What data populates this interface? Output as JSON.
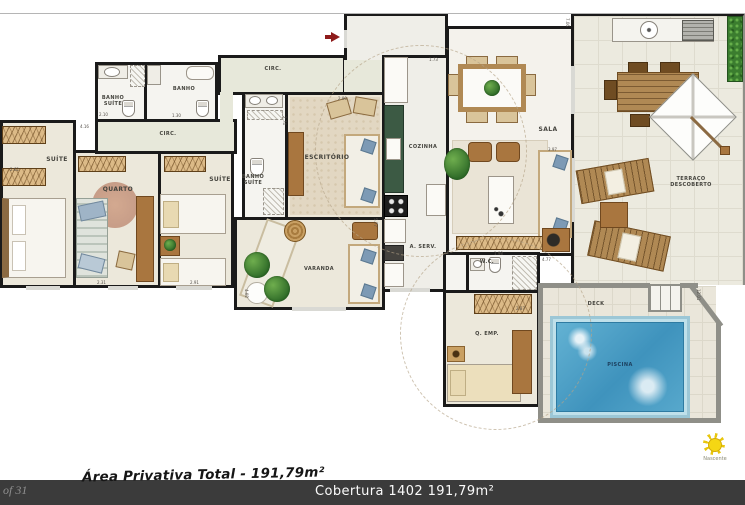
{
  "rooms": {
    "suite1": "SUÍTE",
    "quarto": "QUARTO",
    "suite2": "SUÍTE",
    "banho_suite1": "BANHO SUÍTE",
    "banho": "BANHO",
    "circ1": "CIRC.",
    "circ2": "CIRC.",
    "banho_suite2": "BANHO SUÍTE",
    "escritorio": "ESCRITÓRIO",
    "cozinha": "COZINHA",
    "a_serv": "A. SERV.",
    "sala": "SALA",
    "varanda": "VARANDA",
    "wc": "W.C.",
    "q_emp": "Q. EMP.",
    "terraco": "TERRAÇO DESCOBERTO",
    "deck": "DECK",
    "piscina": "PISCINA"
  },
  "dimensions": [
    {
      "t": "2.10",
      "x": 99,
      "y": 112,
      "r": 0
    },
    {
      "t": "4.16",
      "x": 80,
      "y": 124,
      "r": 0
    },
    {
      "t": "1.30",
      "x": 172,
      "y": 113,
      "r": 0
    },
    {
      "t": "2.62",
      "x": 10,
      "y": 167,
      "r": 0
    },
    {
      "t": "2.31",
      "x": 97,
      "y": 280,
      "r": 0
    },
    {
      "t": "2.91",
      "x": 190,
      "y": 280,
      "r": 0
    },
    {
      "t": "4.02",
      "x": 249,
      "y": 289,
      "r": 90
    },
    {
      "t": "2.90",
      "x": 338,
      "y": 96,
      "r": 0
    },
    {
      "t": "1.73",
      "x": 429,
      "y": 57,
      "r": 0
    },
    {
      "t": "3.97",
      "x": 548,
      "y": 147,
      "r": 0
    },
    {
      "t": "4.77",
      "x": 542,
      "y": 257,
      "r": 0
    },
    {
      "t": "2.87",
      "x": 516,
      "y": 306,
      "r": 0
    },
    {
      "t": "12.01",
      "x": 701,
      "y": 289,
      "r": 90
    },
    {
      "t": "7.06",
      "x": 570,
      "y": 18,
      "r": 90
    },
    {
      "t": "1.98",
      "x": 494,
      "y": 251,
      "r": 0
    },
    {
      "t": "5.77",
      "x": 378,
      "y": 218,
      "r": 90
    },
    {
      "t": "2.74",
      "x": 287,
      "y": 116,
      "r": 90
    }
  ],
  "footer": {
    "page_indicator": "of 31",
    "area_caption": "Área Privativa Total - 191,79m²",
    "bar_text": "Cobertura 1402 191,79m²"
  },
  "legend": {
    "sun_label": "Nascente"
  },
  "colors": {
    "wall": "#1a1a1a",
    "pool_water": "#4ba4cb",
    "bottom_bar": "#3b3b3b",
    "entrance_arrow": "#8e1b1b",
    "floor_cream": "#ece8db"
  }
}
